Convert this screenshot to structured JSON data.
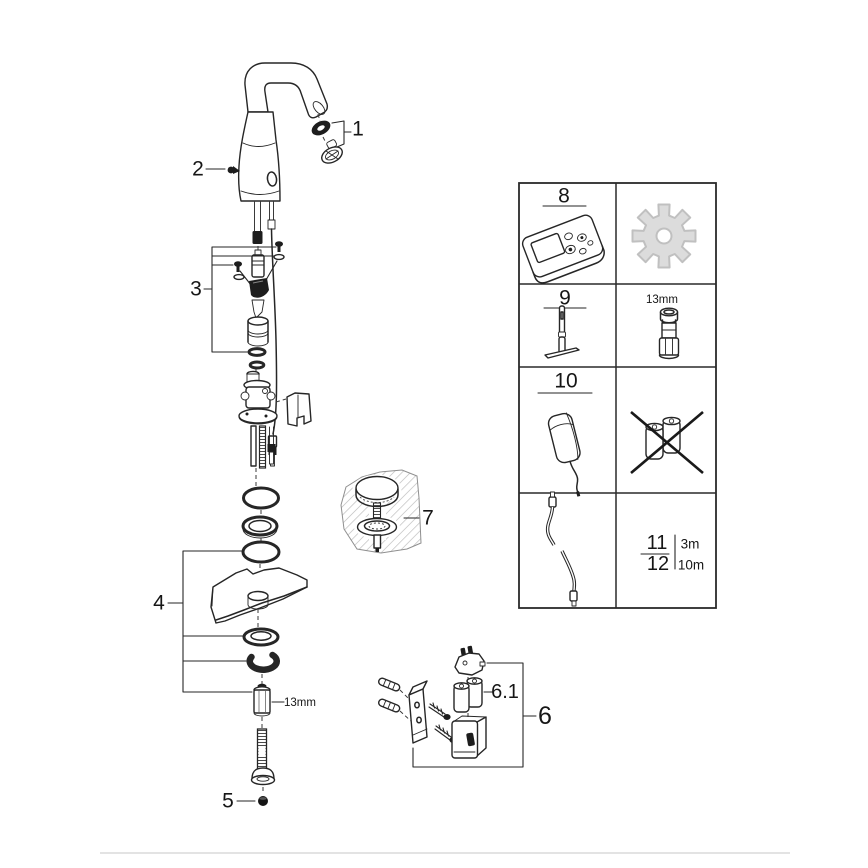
{
  "document": {
    "type": "exploded-parts-diagram",
    "subject": "electronic sensor basin faucet with battery box and accessories",
    "background": "#ffffff"
  },
  "colors": {
    "line": "#262626",
    "text": "#161616",
    "gear_fill": "#dcdcdc",
    "gear_stroke": "#c0c0c0",
    "hatch": "#b8b8b8",
    "divider": "#e3e3e3",
    "dark_part": "#1d1d1d"
  },
  "callouts": {
    "part1": "1",
    "part2": "2",
    "part3": "3",
    "part4": "4",
    "part5": "5",
    "part6": "6",
    "part6_1": "6.1",
    "part7": "7"
  },
  "annotations": {
    "adapter_size": "13mm"
  },
  "accessory_table": {
    "item8": {
      "number": "8",
      "item": "remote-control"
    },
    "gear_item": {
      "item": "service-gear"
    },
    "item9": {
      "number": "9",
      "item": "mounting-tool"
    },
    "socket_item": {
      "size": "13mm",
      "item": "socket-wrench"
    },
    "item10": {
      "number": "10",
      "item": "power-supply"
    },
    "batteries_item": {
      "item": "batteries-crossed-out"
    },
    "cable_item": {
      "item": "extension-cable"
    },
    "item11": {
      "number": "11",
      "length": "3m"
    },
    "item12": {
      "number": "12",
      "length": "10m"
    }
  }
}
